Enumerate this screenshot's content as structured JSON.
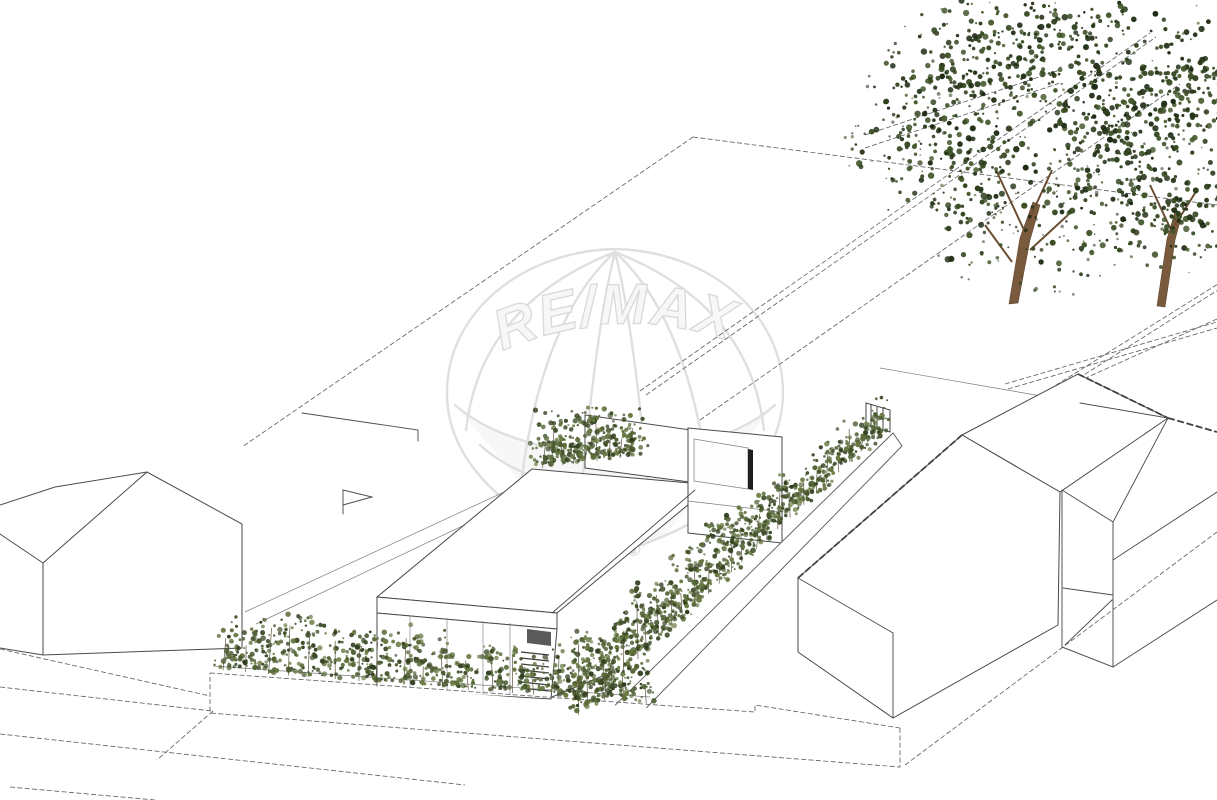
{
  "watermark": {
    "brand": "RE/MAX",
    "registered": "®",
    "outline_color": "#dedede",
    "text_fill": "#f7f7f7"
  },
  "colors": {
    "background": "#ffffff",
    "line": "#4d4d4d",
    "ground_line": "#636363",
    "window_frame_dark": "#1f1f1f",
    "garage_header": "#5a5a5a",
    "trunk": "#7a5a3c",
    "branch": "#6b4e33",
    "hedge_foliage": [
      "#4a5a2e",
      "#5a6c38",
      "#3c4c26",
      "#66783f",
      "#303e1e"
    ],
    "tree_foliage": [
      "#243318",
      "#2c3e1b",
      "#1d2a12",
      "#36491f",
      "#42562a"
    ],
    "stem": "#5d5640"
  },
  "scene": {
    "elements": [
      "remax-balloon-watermark",
      "left-gabled-house",
      "modern-flat-roof-house",
      "right-gabled-house",
      "far-right-house",
      "retaining-wall",
      "front-hedge",
      "side-hedge",
      "garden-trees"
    ]
  }
}
